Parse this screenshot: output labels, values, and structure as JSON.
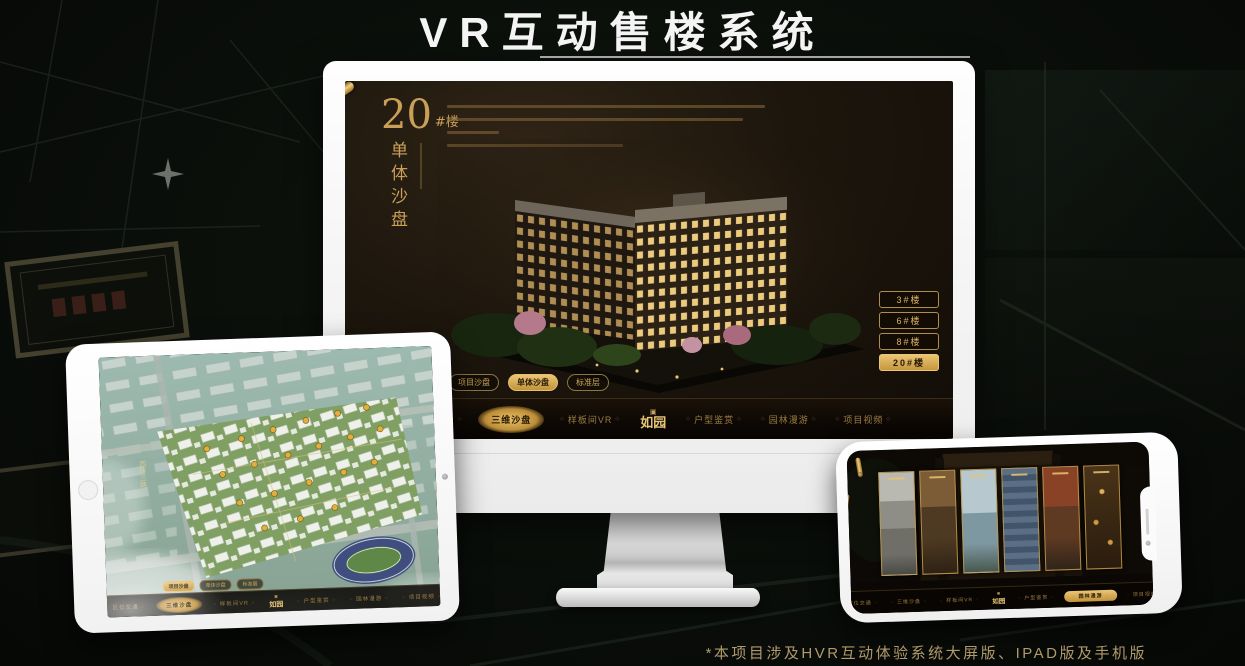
{
  "page": {
    "title": "VR互动售楼系统",
    "footnote": "*本项目涉及HVR互动体验系统大屏版、IPAD版及手机版"
  },
  "colors": {
    "gold": "#c99a52",
    "gold_bright": "#e8c87a",
    "active_gold_bg": "#d9a94e",
    "screen_dark": "#171007",
    "page_bg": "#0a0e0a"
  },
  "icons": {
    "seal": "▣"
  },
  "monitor": {
    "panel": {
      "number": "20",
      "suffix": "#楼",
      "vertical_title": "单体沙盘"
    },
    "floor_buttons": [
      {
        "label": "3#楼",
        "active": false
      },
      {
        "label": "6#楼",
        "active": false
      },
      {
        "label": "8#楼",
        "active": false
      },
      {
        "label": "20#楼",
        "active": true
      }
    ],
    "sub_tabs": [
      {
        "label": "项目沙盘",
        "active": false
      },
      {
        "label": "单体沙盘",
        "active": true
      },
      {
        "label": "标准层",
        "active": false
      }
    ],
    "nav": {
      "items_left": [
        {
          "label": "区位交通",
          "active": false
        },
        {
          "label": "三维沙盘",
          "active": true
        },
        {
          "label": "样板间VR",
          "active": false
        }
      ],
      "logo": "如园",
      "items_right": [
        {
          "label": "户型鉴赏",
          "active": false
        },
        {
          "label": "园林漫游",
          "active": false
        },
        {
          "label": "项目视频",
          "active": false
        }
      ]
    }
  },
  "tablet": {
    "road_label": "西环三路",
    "sub_tabs": [
      {
        "label": "项目沙盘",
        "active": true
      },
      {
        "label": "单体沙盘",
        "active": false
      },
      {
        "label": "标准层",
        "active": false
      }
    ],
    "nav": {
      "items_left": [
        {
          "label": "区位交通",
          "active": false
        },
        {
          "label": "三维沙盘",
          "active": true
        },
        {
          "label": "样板间VR",
          "active": false
        }
      ],
      "logo": "如园",
      "items_right": [
        {
          "label": "户型鉴赏",
          "active": false
        },
        {
          "label": "园林漫游",
          "active": false
        },
        {
          "label": "项目视频",
          "active": false
        }
      ]
    }
  },
  "phone": {
    "nav": {
      "items_left": [
        {
          "label": "区位交通",
          "active": false
        },
        {
          "label": "三维沙盘",
          "active": false
        },
        {
          "label": "样板间VR",
          "active": false
        }
      ],
      "logo": "如园",
      "items_right": [
        {
          "label": "户型鉴赏",
          "active": false
        },
        {
          "label": "园林漫游",
          "active": true
        },
        {
          "label": "项目视频",
          "active": false
        }
      ]
    }
  }
}
